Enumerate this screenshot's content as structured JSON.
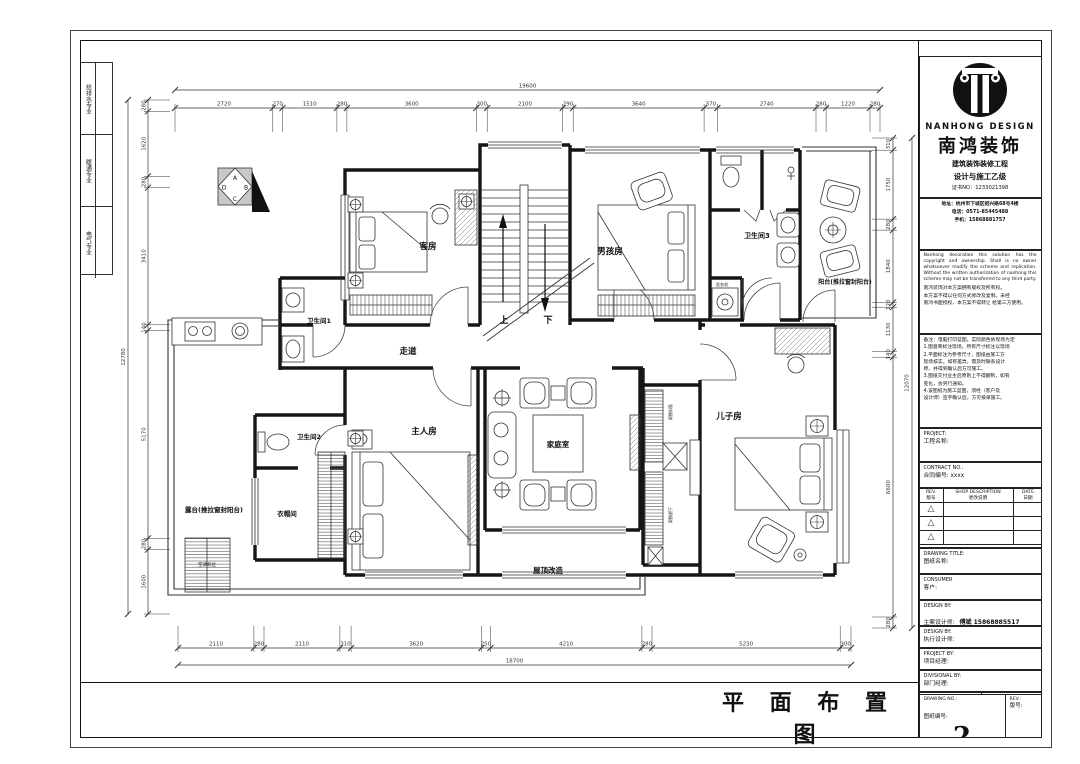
{
  "sheet": {
    "main_title": "平 面 布 置 图",
    "tri_icon": "△"
  },
  "margin": {
    "disciplines": [
      "给排水专业",
      "暖通专业",
      "电气专业"
    ]
  },
  "compass": {
    "letters": [
      "A",
      "B",
      "C",
      "D"
    ]
  },
  "plan": {
    "rooms": {
      "guest_room": "客房",
      "boys_room": "男孩房",
      "bath3": "卫生间3",
      "balcony_right": "阳台(推拉窗封阳台)",
      "corridor": "走道",
      "bath1": "卫生间1",
      "master_room": "主人房",
      "family_room": "家庭室",
      "sons_room": "儿子房",
      "bath2": "卫生间2",
      "cloakroom": "衣帽间",
      "terrace": "露台(推拉窗封阳台)",
      "roof": "屋顶改造",
      "laundry": "洗衣机",
      "ac_platform": "空调机位",
      "shaft1": "强排烟道",
      "shaft2": "土建烟道",
      "stair_up": "上",
      "stair_down": "下"
    }
  },
  "dims": {
    "top": {
      "total": "19600",
      "segments": [
        "2720",
        "270",
        "1510",
        "280",
        "3600",
        "300",
        "2100",
        "290",
        "3640",
        "370",
        "2740",
        "280",
        "1220",
        "280"
      ]
    },
    "bottom": {
      "total": "18700",
      "segments": [
        "2110",
        "280",
        "2110",
        "310",
        "3620",
        "250",
        "4210",
        "280",
        "5230",
        "300"
      ]
    },
    "left": {
      "total": "12780",
      "segments": [
        "280",
        "1620",
        "280",
        "3410",
        "140",
        "5170",
        "280",
        "1600"
      ]
    },
    "right": {
      "total": "12070",
      "segments": [
        "310",
        "1750",
        "280",
        "1840",
        "120",
        "1130",
        "140",
        "6600",
        "280"
      ]
    }
  },
  "title_block": {
    "logo_en": "NANHONG DESIGN",
    "logo_cn": "南鸿装饰",
    "logo_sub1": "建筑装饰装修工程",
    "logo_sub2": "设计与施工乙级",
    "logo_cert": "证书NO：1233021398",
    "addr": "地址：杭州市下城区绍兴路68号4楼",
    "tel": "电话：0571-85445488",
    "mobile": "手机：15868881757",
    "copyright_en": "Nanhong decoration this solution has the copyright and ownership. Shall is no owner whatsoever modify the scheme and replication. Without the written authorization of nanhong this scheme may not be transferred to any third party.",
    "copyright_cn1": "南鸿装饰对本方案拥有版权及所有权。",
    "copyright_cn2": "本方案不得以任何方式修改及复制。未经",
    "copyright_cn3": "南鸿书面授权，本方案不得转让 给第三方使用。",
    "notes_lines": [
      "备注：电脑打印蓝图，实际颜色依现场为定",
      "1.图督商标注现场，所有尺寸标注以现场",
      "2.平面标注为参考尺寸，图纸由施工方",
      "现场核实。如有差异，需及时联系设计",
      "师，并得到确认后方可施工。",
      "3.图纸交付业主后原则上不得翻制，如有",
      "变化，会另行通知。",
      "4.该图纸为施工蓝图，须经（客户及",
      "设计师）签字确认后，方可按单施工。"
    ],
    "project_en": "PROJECT:",
    "project_cn": "工程名称:",
    "contract_en": "CONTRACT NO.:",
    "contract_cn": "合同编号: xxxx",
    "rev_col1_en": "REV.",
    "rev_col1_cn": "版号",
    "rev_col2_en": "SHOP DESCRIPTION",
    "rev_col2_cn": "更改说明",
    "rev_col3_en": "DATE",
    "rev_col3_cn": "日期",
    "drawing_title_en": "DRAWING TITLE:",
    "drawing_title_cn": "图纸名称:",
    "consumer_en": "CONSUMER",
    "consumer_cn": "客户:",
    "design1_en": "DESIGN BY:",
    "design1_cn": "主案设计师:",
    "design1_val": "傅斌 15868885517",
    "design2_en": "DESIGN BY:",
    "design2_cn": "执行设计师:",
    "project_by_en": "PROJECT BY:",
    "project_by_cn": "项目经理:",
    "divisional_en": "DIVISIONAL BY:",
    "divisional_cn": "部门经理:",
    "drawn_en": "DRAWN BY:",
    "drawn_cn": "制图人:",
    "date_en": "DATE:",
    "date_cn": "日期:",
    "approved_en": "APPROVED BY:",
    "approved_cn": "图纸审核人:",
    "scale_en": "SCALE:",
    "scale_cn": "比例:",
    "dwgno_en": "DRAWING NO.:",
    "dwgno_cn": "图纸编号:",
    "dwgno_val": "2",
    "rev_en": "REV.:",
    "rev_cn": "版号:"
  }
}
